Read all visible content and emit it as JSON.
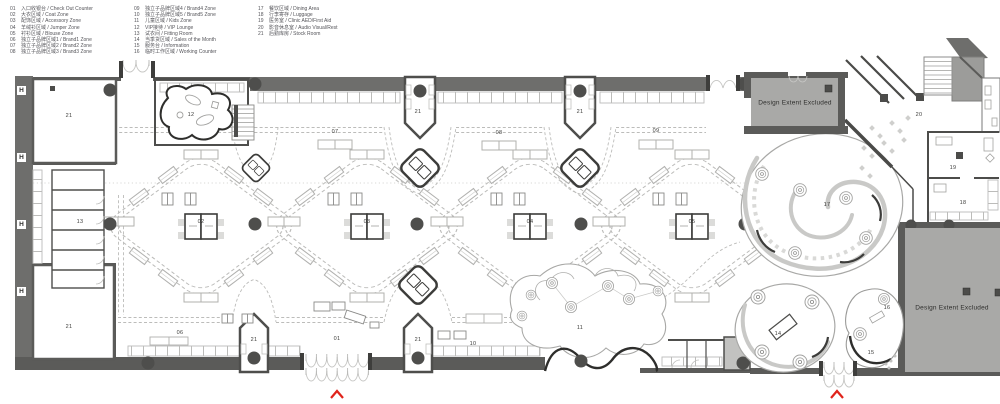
{
  "legend": {
    "col1": [
      {
        "num": "01",
        "label": "入口收银台 / Check Out Counter"
      },
      {
        "num": "02",
        "label": "大衣区域 / Coat Zone"
      },
      {
        "num": "03",
        "label": "配饰区域 / Accessory Zone"
      },
      {
        "num": "04",
        "label": "羊绒衫区域 / Jumper Zone"
      },
      {
        "num": "05",
        "label": "衬衫区域 / Blouse Zone"
      },
      {
        "num": "06",
        "label": "独立子品牌区域1 / Brand1 Zone"
      },
      {
        "num": "07",
        "label": "独立子品牌区域2 / Brand2 Zone"
      },
      {
        "num": "08",
        "label": "独立子品牌区域3 / Brand3 Zone"
      }
    ],
    "col2": [
      {
        "num": "09",
        "label": "独立子品牌区域4 / Brand4 Zone"
      },
      {
        "num": "10",
        "label": "独立子品牌区域5 / Brand5 Zone"
      },
      {
        "num": "11",
        "label": "儿童区域 / Kids Zone"
      },
      {
        "num": "12",
        "label": "VIP接待 / VIP Lounge"
      },
      {
        "num": "13",
        "label": "试衣间 / Fitting Room"
      },
      {
        "num": "14",
        "label": "当季货区域 / Sales of the Month"
      },
      {
        "num": "15",
        "label": "服务台 / Information"
      },
      {
        "num": "16",
        "label": "临时工作区域 / Working Counter"
      }
    ],
    "col3": [
      {
        "num": "17",
        "label": "餐饮区域 / Dining Area"
      },
      {
        "num": "18",
        "label": "行李寄存 / Luggage"
      },
      {
        "num": "19",
        "label": "医务室 / Clinic AED/First Aid"
      },
      {
        "num": "20",
        "label": "影音休息室 / Audio Visual/Rest"
      },
      {
        "num": "21",
        "label": "后勤库房 / Stock Room"
      }
    ]
  },
  "plan": {
    "design_extent_label": "Design Extent Excluded",
    "grid_markers": [
      {
        "label": "H",
        "x": 21,
        "y": 90
      },
      {
        "label": "H",
        "x": 21,
        "y": 157
      },
      {
        "label": "H",
        "x": 21,
        "y": 224
      },
      {
        "label": "H",
        "x": 21,
        "y": 291
      }
    ],
    "zone_labels": [
      {
        "num": "21",
        "x": 69,
        "y": 116
      },
      {
        "num": "12",
        "x": 191,
        "y": 115
      },
      {
        "num": "21",
        "x": 418,
        "y": 112
      },
      {
        "num": "21",
        "x": 580,
        "y": 112
      },
      {
        "num": "07",
        "x": 335,
        "y": 132
      },
      {
        "num": "08",
        "x": 499,
        "y": 133
      },
      {
        "num": "09",
        "x": 656,
        "y": 131
      },
      {
        "num": "20",
        "x": 919,
        "y": 115
      },
      {
        "num": "13",
        "x": 80,
        "y": 222
      },
      {
        "num": "02",
        "x": 201,
        "y": 222
      },
      {
        "num": "03",
        "x": 367,
        "y": 222
      },
      {
        "num": "04",
        "x": 530,
        "y": 222
      },
      {
        "num": "05",
        "x": 692,
        "y": 222
      },
      {
        "num": "17",
        "x": 827,
        "y": 205
      },
      {
        "num": "19",
        "x": 953,
        "y": 168
      },
      {
        "num": "18",
        "x": 963,
        "y": 203
      },
      {
        "num": "21",
        "x": 69,
        "y": 327
      },
      {
        "num": "06",
        "x": 180,
        "y": 333
      },
      {
        "num": "01",
        "x": 337,
        "y": 339
      },
      {
        "num": "10",
        "x": 473,
        "y": 344
      },
      {
        "num": "21",
        "x": 254,
        "y": 340
      },
      {
        "num": "21",
        "x": 418,
        "y": 340
      },
      {
        "num": "11",
        "x": 580,
        "y": 328
      },
      {
        "num": "14",
        "x": 778,
        "y": 334
      },
      {
        "num": "16",
        "x": 887,
        "y": 308
      },
      {
        "num": "15",
        "x": 871,
        "y": 353
      }
    ]
  },
  "colors": {
    "wall": "#5b5b59",
    "band": "#6e6e6c",
    "excluded_fill": "#a9a9a7",
    "fixture_light": "#b0b0ae",
    "fixture_bold": "#3c3c3a",
    "dashed_path": "#bcbcba",
    "column": "#4e4e4c",
    "entrance_arrow_red": "#e0241b"
  }
}
